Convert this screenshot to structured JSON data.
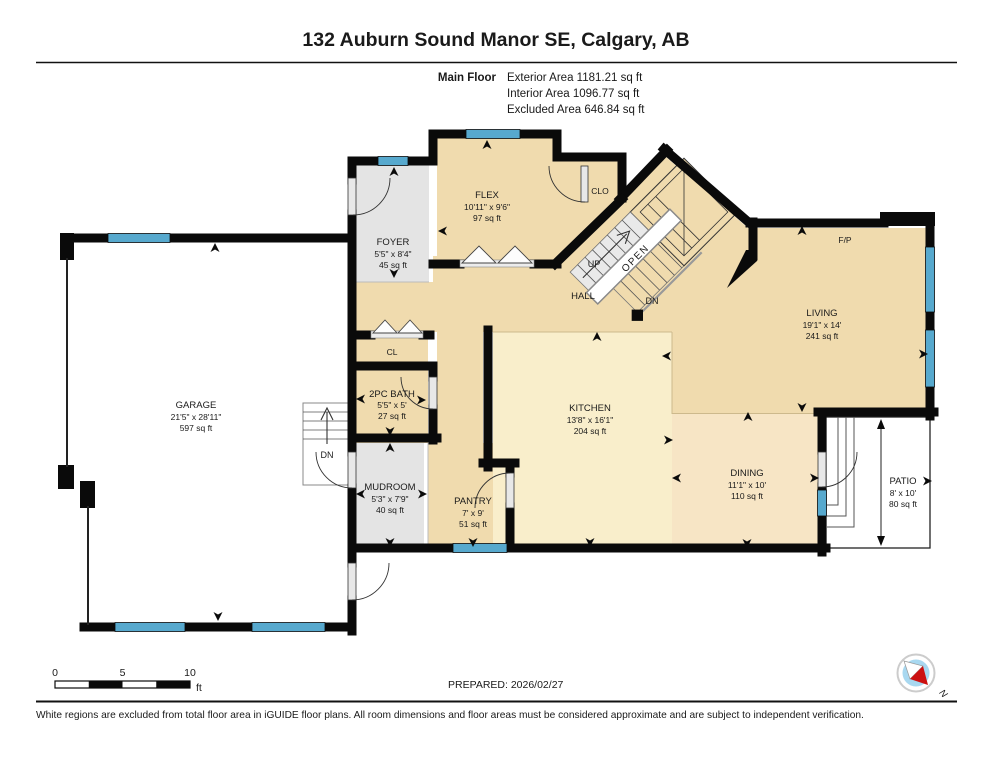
{
  "header": {
    "title": "132 Auburn Sound Manor SE, Calgary, AB",
    "floor_label": "Main Floor",
    "exterior_area": "Exterior Area 1181.21 sq ft",
    "interior_area": "Interior Area 1096.77 sq ft",
    "excluded_area": "Excluded Area 646.84 sq ft"
  },
  "rooms": {
    "foyer": {
      "name": "FOYER",
      "dims": "5'5\" x 8'4\"",
      "area": "45 sq ft"
    },
    "flex": {
      "name": "FLEX",
      "dims": "10'11\" x 9'6\"",
      "area": "97 sq ft"
    },
    "clo": {
      "name": "CLO"
    },
    "living": {
      "name": "LIVING",
      "dims": "19'1\" x 14'",
      "area": "241 sq ft"
    },
    "fireplace": {
      "name": "F/P"
    },
    "garage": {
      "name": "GARAGE",
      "dims": "21'5\" x 28'11\"",
      "area": "597 sq ft"
    },
    "cl": {
      "name": "CL"
    },
    "bath": {
      "name": "2PC BATH",
      "dims": "5'5\" x 5'",
      "area": "27 sq ft"
    },
    "kitchen": {
      "name": "KITCHEN",
      "dims": "13'8\" x 16'1\"",
      "area": "204 sq ft"
    },
    "mudroom": {
      "name": "MUDROOM",
      "dims": "5'3\" x 7'9\"",
      "area": "40 sq ft"
    },
    "pantry": {
      "name": "PANTRY",
      "dims": "7' x 9'",
      "area": "51 sq ft"
    },
    "dining": {
      "name": "DINING",
      "dims": "11'1\" x 10'",
      "area": "110 sq ft"
    },
    "patio": {
      "name": "PATIO",
      "dims": "8' x 10'",
      "area": "80 sq ft"
    },
    "hall": {
      "name": "HALL"
    }
  },
  "stairs": {
    "up": "UP",
    "down": "DN",
    "open": "OPEN",
    "garage_down": "DN"
  },
  "scale_bar": {
    "tick0": "0",
    "tick1": "5",
    "tick2": "10",
    "unit": "ft"
  },
  "prepared_label": "PREPARED: 2026/02/27",
  "compass": {
    "north": "N"
  },
  "footer_note": "White regions are excluded from total floor area in iGUIDE floor plans. All room dimensions and floor areas must be considered approximate and are subject to independent verification.",
  "colors": {
    "floor_tan": "#f0dbae",
    "floor_cream": "#f9eecb",
    "floor_peach": "#f7e5c5",
    "floor_gray": "#e4e4e4",
    "stair_gray": "#e9e9e9",
    "window_blue": "#57a9ce",
    "wall_black": "#0a0a0a",
    "compass_blue": "#a8d8f0",
    "compass_red": "#cc1111"
  }
}
